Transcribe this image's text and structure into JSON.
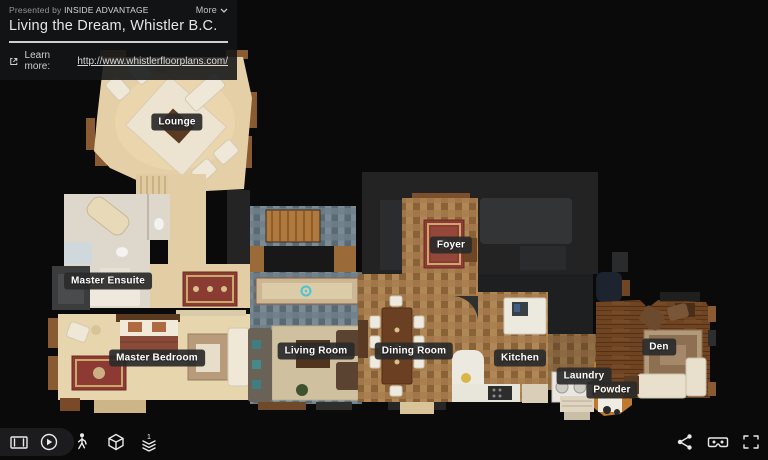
{
  "header": {
    "presented_by_label": "Presented by",
    "presenter_name": "INSIDE ADVANTAGE",
    "more_label": "More",
    "title": "Living the Dream, Whistler B.C.",
    "learn_more_label": "Learn more:",
    "learn_more_url": "http://www.whistlerfloorplans.com/"
  },
  "floorplan": {
    "view_mode": "floorplan",
    "current_floor": "1",
    "rooms": [
      {
        "name": "Lounge",
        "x": 177,
        "y": 122
      },
      {
        "name": "Master Ensuite",
        "x": 108,
        "y": 281
      },
      {
        "name": "Master Bedroom",
        "x": 157,
        "y": 358
      },
      {
        "name": "Living Room",
        "x": 316,
        "y": 351
      },
      {
        "name": "Dining Room",
        "x": 414,
        "y": 351
      },
      {
        "name": "Foyer",
        "x": 451,
        "y": 245
      },
      {
        "name": "Kitchen",
        "x": 520,
        "y": 358
      },
      {
        "name": "Laundry",
        "x": 584,
        "y": 376
      },
      {
        "name": "Powder",
        "x": 612,
        "y": 390
      },
      {
        "name": "Den",
        "x": 659,
        "y": 347
      }
    ]
  },
  "toolbar": {
    "left_icons": [
      "highlight-reel-icon",
      "play-icon",
      "walk-icon",
      "dollhouse-icon",
      "floorplan-icon"
    ],
    "right_icons": [
      "share-icon",
      "vr-icon",
      "fullscreen-icon"
    ]
  },
  "colors": {
    "background": "#0a0a0b",
    "panel_bg": "#141619",
    "label_bg": "#2a2a2a",
    "label_text": "#ffffff",
    "divider": "#cfcfcf",
    "tile_tan": "#9c7040",
    "tile_slate": "#64747e",
    "carpet_beige": "#e6d4ac",
    "hardwood": "#6e4423",
    "marker_cyan": "#45c6d8"
  }
}
